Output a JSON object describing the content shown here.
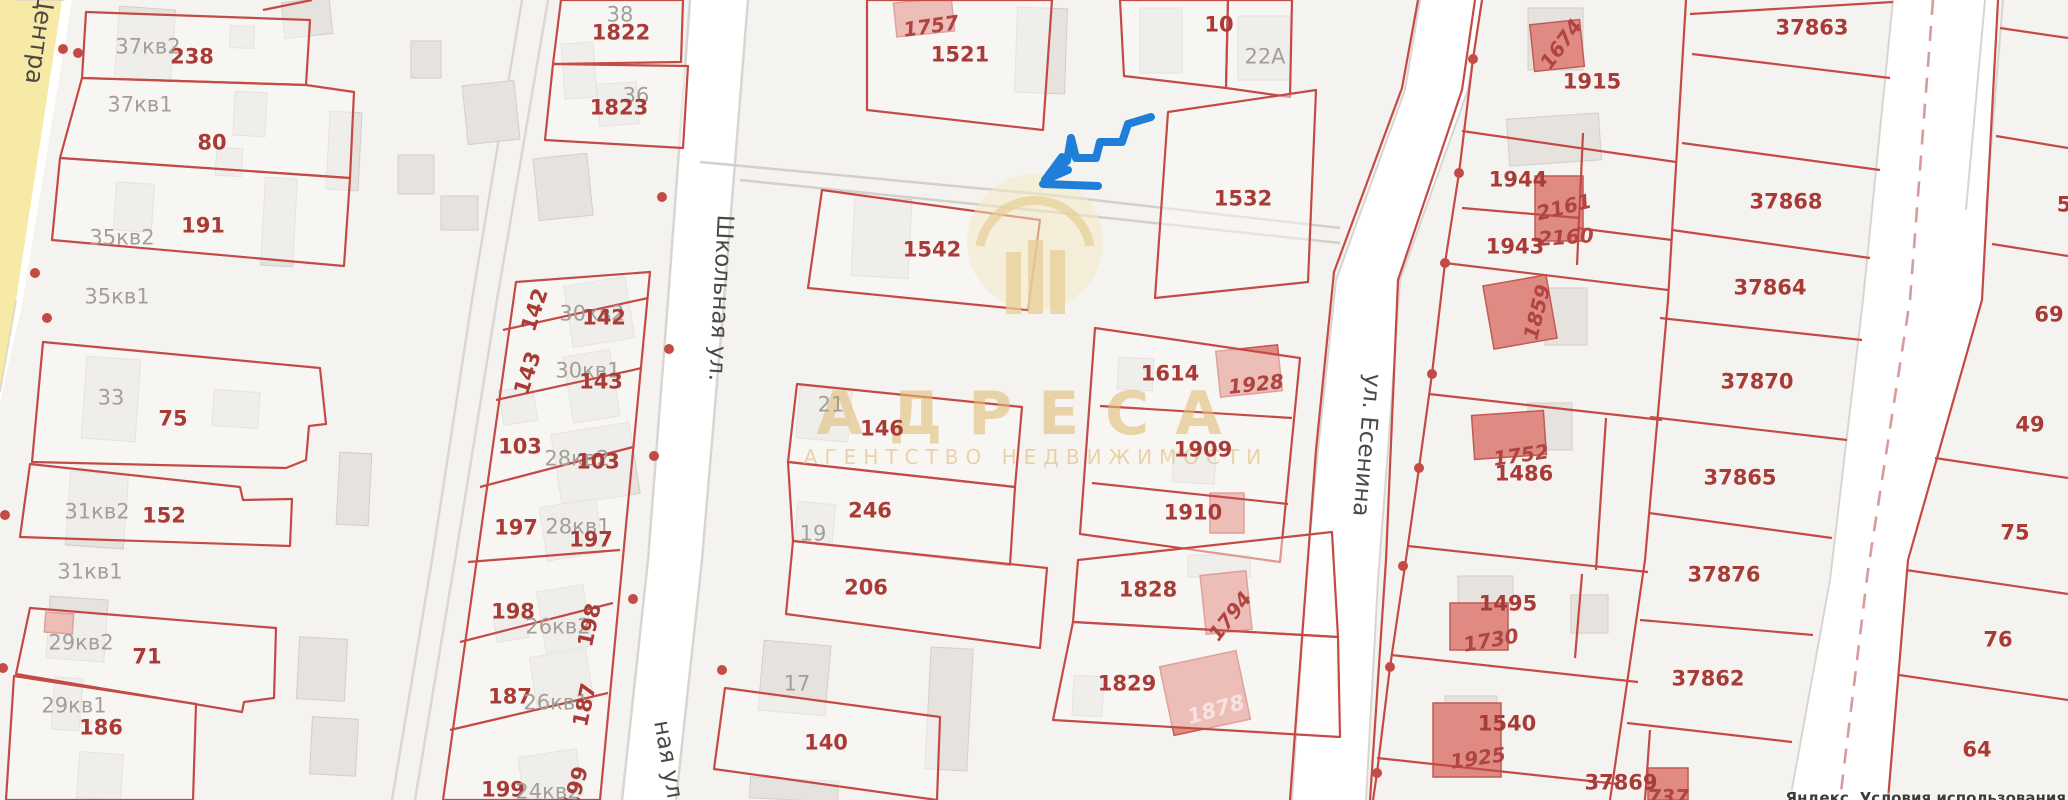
{
  "map": {
    "watermark": {
      "title": "АДРЕСА",
      "subtitle": "АГЕНТСТВО НЕДВИЖИМОСТИ"
    },
    "attribution": "Яндекс. Условия использования",
    "colors": {
      "parcel_line": "#c44a45",
      "red_building": "#e08a84",
      "gray_building": "#e6e3df",
      "road_yellow": "#f7e9a6",
      "road_white": "#ffffff",
      "annotation_blue": "#1f7fd8",
      "red_label": "#a93b37",
      "gray_label": "#a29f99",
      "watermark_gold": "#e0bc76"
    }
  },
  "labels": [
    {
      "t": "Центра",
      "x": 40,
      "y": 38,
      "k": "street",
      "r": 98,
      "s": 24
    },
    {
      "t": "Школьная ул.",
      "x": 720,
      "y": 298,
      "k": "street",
      "r": 93,
      "s": 23
    },
    {
      "t": "ная ул.",
      "x": 668,
      "y": 763,
      "k": "street",
      "r": 80,
      "s": 23
    },
    {
      "t": "ул. Есенина",
      "x": 1366,
      "y": 445,
      "k": "street",
      "r": 95,
      "s": 23
    },
    {
      "t": "238",
      "x": 192,
      "y": 57,
      "k": "red"
    },
    {
      "t": "80",
      "x": 212,
      "y": 143,
      "k": "red"
    },
    {
      "t": "191",
      "x": 203,
      "y": 226,
      "k": "red"
    },
    {
      "t": "75",
      "x": 173,
      "y": 419,
      "k": "red"
    },
    {
      "t": "152",
      "x": 164,
      "y": 516,
      "k": "red"
    },
    {
      "t": "71",
      "x": 147,
      "y": 657,
      "k": "red"
    },
    {
      "t": "186",
      "x": 101,
      "y": 728,
      "k": "red"
    },
    {
      "t": "37кв2",
      "x": 148,
      "y": 47,
      "k": "gray"
    },
    {
      "t": "37кв1",
      "x": 140,
      "y": 105,
      "k": "gray"
    },
    {
      "t": "35кв2",
      "x": 122,
      "y": 238,
      "k": "gray"
    },
    {
      "t": "35кв1",
      "x": 117,
      "y": 297,
      "k": "gray"
    },
    {
      "t": "33",
      "x": 111,
      "y": 398,
      "k": "gray"
    },
    {
      "t": "31кв2",
      "x": 97,
      "y": 512,
      "k": "gray"
    },
    {
      "t": "31кв1",
      "x": 90,
      "y": 572,
      "k": "gray"
    },
    {
      "t": "29кв2",
      "x": 81,
      "y": 643,
      "k": "gray"
    },
    {
      "t": "29кв1",
      "x": 74,
      "y": 706,
      "k": "gray"
    },
    {
      "t": "38",
      "x": 620,
      "y": 15,
      "k": "gray"
    },
    {
      "t": "1822",
      "x": 621,
      "y": 33,
      "k": "red"
    },
    {
      "t": "36",
      "x": 636,
      "y": 96,
      "k": "gray"
    },
    {
      "t": "1823",
      "x": 619,
      "y": 108,
      "k": "red"
    },
    {
      "t": "142",
      "x": 535,
      "y": 310,
      "k": "redrot",
      "r": -72
    },
    {
      "t": "30кв2",
      "x": 592,
      "y": 314,
      "k": "gray"
    },
    {
      "t": "142",
      "x": 604,
      "y": 318,
      "k": "red"
    },
    {
      "t": "143",
      "x": 528,
      "y": 373,
      "k": "redrot",
      "r": -72
    },
    {
      "t": "30кв1",
      "x": 588,
      "y": 371,
      "k": "gray"
    },
    {
      "t": "143",
      "x": 601,
      "y": 382,
      "k": "red"
    },
    {
      "t": "103",
      "x": 520,
      "y": 447,
      "k": "red"
    },
    {
      "t": "28кв2",
      "x": 577,
      "y": 459,
      "k": "gray"
    },
    {
      "t": "103",
      "x": 598,
      "y": 462,
      "k": "red"
    },
    {
      "t": "197",
      "x": 516,
      "y": 528,
      "k": "red"
    },
    {
      "t": "28кв1",
      "x": 578,
      "y": 527,
      "k": "gray"
    },
    {
      "t": "197",
      "x": 591,
      "y": 540,
      "k": "red"
    },
    {
      "t": "198",
      "x": 513,
      "y": 612,
      "k": "red"
    },
    {
      "t": "26кв2",
      "x": 558,
      "y": 627,
      "k": "gray"
    },
    {
      "t": "198",
      "x": 590,
      "y": 625,
      "k": "redrot",
      "r": -78
    },
    {
      "t": "187",
      "x": 510,
      "y": 697,
      "k": "red"
    },
    {
      "t": "26кв1",
      "x": 556,
      "y": 703,
      "k": "gray"
    },
    {
      "t": "187",
      "x": 585,
      "y": 705,
      "k": "redrot",
      "r": -78
    },
    {
      "t": "199",
      "x": 503,
      "y": 790,
      "k": "red"
    },
    {
      "t": "24кв2",
      "x": 548,
      "y": 792,
      "k": "gray"
    },
    {
      "t": "199",
      "x": 576,
      "y": 788,
      "k": "redrot",
      "r": -74
    },
    {
      "t": "1757",
      "x": 931,
      "y": 26,
      "k": "redit",
      "r": -8
    },
    {
      "t": "1521",
      "x": 960,
      "y": 55,
      "k": "red"
    },
    {
      "t": "10",
      "x": 1219,
      "y": 25,
      "k": "red"
    },
    {
      "t": "22A",
      "x": 1265,
      "y": 57,
      "k": "gray"
    },
    {
      "t": "1532",
      "x": 1243,
      "y": 199,
      "k": "red"
    },
    {
      "t": "1542",
      "x": 932,
      "y": 250,
      "k": "red"
    },
    {
      "t": "21",
      "x": 831,
      "y": 405,
      "k": "gray"
    },
    {
      "t": "146",
      "x": 882,
      "y": 429,
      "k": "red"
    },
    {
      "t": "246",
      "x": 870,
      "y": 511,
      "k": "red"
    },
    {
      "t": "19",
      "x": 813,
      "y": 534,
      "k": "gray"
    },
    {
      "t": "206",
      "x": 866,
      "y": 588,
      "k": "red"
    },
    {
      "t": "17",
      "x": 797,
      "y": 684,
      "k": "gray"
    },
    {
      "t": "140",
      "x": 826,
      "y": 743,
      "k": "red"
    },
    {
      "t": "1614",
      "x": 1170,
      "y": 374,
      "k": "red"
    },
    {
      "t": "1928",
      "x": 1256,
      "y": 384,
      "k": "redit",
      "r": -6
    },
    {
      "t": "1909",
      "x": 1203,
      "y": 450,
      "k": "red"
    },
    {
      "t": "1910",
      "x": 1193,
      "y": 513,
      "k": "red"
    },
    {
      "t": "1828",
      "x": 1148,
      "y": 590,
      "k": "red"
    },
    {
      "t": "1794",
      "x": 1230,
      "y": 616,
      "k": "redit",
      "r": -52
    },
    {
      "t": "1829",
      "x": 1127,
      "y": 684,
      "k": "red"
    },
    {
      "t": "1878",
      "x": 1216,
      "y": 710,
      "k": "whiteit",
      "r": -16
    },
    {
      "t": "1674",
      "x": 1561,
      "y": 44,
      "k": "redit",
      "r": -54
    },
    {
      "t": "1915",
      "x": 1592,
      "y": 82,
      "k": "red"
    },
    {
      "t": "1944",
      "x": 1518,
      "y": 180,
      "k": "red"
    },
    {
      "t": "2161",
      "x": 1564,
      "y": 207,
      "k": "redit",
      "r": -14
    },
    {
      "t": "2160",
      "x": 1566,
      "y": 237,
      "k": "redit",
      "r": -4
    },
    {
      "t": "1943",
      "x": 1515,
      "y": 247,
      "k": "red"
    },
    {
      "t": "1859",
      "x": 1537,
      "y": 312,
      "k": "redit",
      "r": -76
    },
    {
      "t": "1752",
      "x": 1521,
      "y": 455,
      "k": "redit",
      "r": -8
    },
    {
      "t": "1486",
      "x": 1524,
      "y": 474,
      "k": "red"
    },
    {
      "t": "1495",
      "x": 1508,
      "y": 604,
      "k": "red"
    },
    {
      "t": "1730",
      "x": 1491,
      "y": 640,
      "k": "redit",
      "r": -10
    },
    {
      "t": "1540",
      "x": 1507,
      "y": 724,
      "k": "red"
    },
    {
      "t": "1925",
      "x": 1478,
      "y": 758,
      "k": "redit",
      "r": -8
    },
    {
      "t": "37869",
      "x": 1621,
      "y": 783,
      "k": "red"
    },
    {
      "t": "737",
      "x": 1668,
      "y": 797,
      "k": "redit"
    },
    {
      "t": "37863",
      "x": 1812,
      "y": 28,
      "k": "red"
    },
    {
      "t": "37868",
      "x": 1786,
      "y": 202,
      "k": "red"
    },
    {
      "t": "37864",
      "x": 1770,
      "y": 288,
      "k": "red"
    },
    {
      "t": "37870",
      "x": 1757,
      "y": 382,
      "k": "red"
    },
    {
      "t": "37865",
      "x": 1740,
      "y": 478,
      "k": "red"
    },
    {
      "t": "37876",
      "x": 1724,
      "y": 575,
      "k": "red"
    },
    {
      "t": "37862",
      "x": 1708,
      "y": 679,
      "k": "red"
    },
    {
      "t": "5",
      "x": 2064,
      "y": 205,
      "k": "red"
    },
    {
      "t": "69",
      "x": 2049,
      "y": 315,
      "k": "red"
    },
    {
      "t": "49",
      "x": 2030,
      "y": 425,
      "k": "red"
    },
    {
      "t": "75",
      "x": 2015,
      "y": 533,
      "k": "red"
    },
    {
      "t": "76",
      "x": 1998,
      "y": 640,
      "k": "red"
    },
    {
      "t": "64",
      "x": 1977,
      "y": 750,
      "k": "red"
    }
  ]
}
